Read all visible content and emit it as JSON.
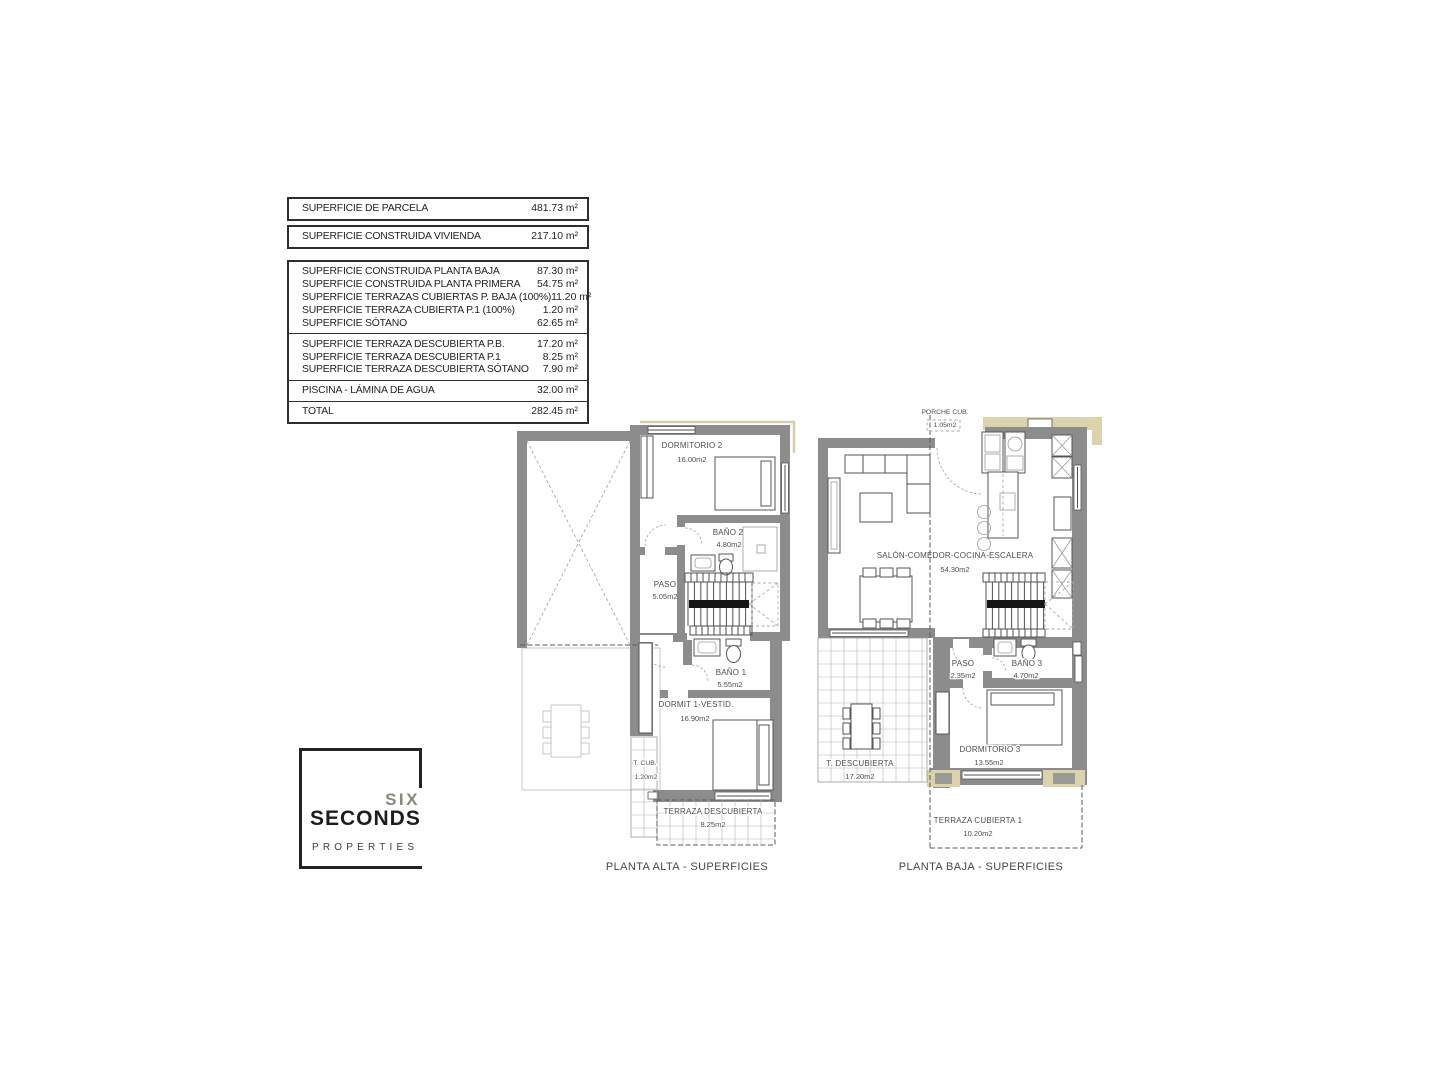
{
  "area_table": {
    "box1": {
      "rows": [
        {
          "label": "SUPERFICIE DE PARCELA",
          "value": "481.73 m²"
        }
      ]
    },
    "box2": {
      "rows": [
        {
          "label": "SUPERFICIE CONSTRUIDA VIVIENDA",
          "value": "217.10 m²"
        }
      ]
    },
    "box3": {
      "sections": [
        {
          "rows": [
            {
              "label": "SUPERFICIE CONSTRUIDA PLANTA BAJA",
              "value": "87.30 m²"
            },
            {
              "label": "SUPERFICIE CONSTRUIDA PLANTA PRIMERA",
              "value": "54.75 m²"
            },
            {
              "label": "SUPERFICIE TERRAZAS CUBIERTAS P. BAJA (100%)",
              "value": "11.20 m²"
            },
            {
              "label": "SUPERFICIE TERRAZA CUBIERTA P.1 (100%)",
              "value": "1.20 m²"
            },
            {
              "label": "SUPERFICIE SÓTANO",
              "value": "62.65 m²"
            }
          ]
        },
        {
          "rows": [
            {
              "label": "SUPERFICIE TERRAZA DESCUBIERTA P.B.",
              "value": "17.20 m²"
            },
            {
              "label": "SUPERFICIE TERRAZA DESCUBIERTA P.1",
              "value": "8.25 m²"
            },
            {
              "label": "SUPERFICIE TERRAZA DESCUBIERTA SÓTANO",
              "value": "7.90 m²"
            }
          ]
        },
        {
          "rows": [
            {
              "label": "PISCINA - LÁMINA DE AGUA",
              "value": "32.00 m²"
            }
          ]
        },
        {
          "rows": [
            {
              "label": "TOTAL",
              "value": "282.45 m²"
            }
          ]
        }
      ]
    }
  },
  "logo": {
    "six": "SIX",
    "seconds": "SECONDS",
    "properties": "PROPERTIES"
  },
  "plans": {
    "left": {
      "caption": "PLANTA ALTA - SUPERFICIES",
      "rooms": {
        "dormitorio2": {
          "name": "DORMITORIO 2",
          "area": "16.00m2"
        },
        "bano2": {
          "name": "BAÑO 2",
          "area": "4.80m2"
        },
        "paso": {
          "name": "PASO",
          "area": "5.05m2"
        },
        "bano1": {
          "name": "BAÑO 1",
          "area": "5.55m2"
        },
        "dormit1": {
          "name": "DORMIT 1-VESTID.",
          "area": "16.90m2"
        },
        "tcub": {
          "name": "T. CUB.",
          "area": "1.20m2"
        },
        "terraza_descubierta": {
          "name": "TERRAZA DESCUBIERTA",
          "area": "8.25m2"
        }
      }
    },
    "right": {
      "caption": "PLANTA BAJA - SUPERFICIES",
      "rooms": {
        "porche": {
          "name": "PORCHE CUB.",
          "area": "1.05m2"
        },
        "salon": {
          "name": "SALÓN-COMEDOR-COCINA-ESCALERA",
          "area": "54.30m2"
        },
        "paso": {
          "name": "PASO",
          "area": "2.35m2"
        },
        "bano3": {
          "name": "BAÑO 3",
          "area": "4.70m2"
        },
        "dormitorio3": {
          "name": "DORMITORIO 3",
          "area": "13.55m2"
        },
        "tdescubierta": {
          "name": "T. DESCUBIERTA",
          "area": "17.20m2"
        },
        "terraza_cubierta1": {
          "name": "TERRAZA CUBIERTA 1",
          "area": "10.20m2"
        }
      }
    }
  },
  "colors": {
    "wall": "#8c8c8c",
    "tan_accent": "#dcd2ae",
    "ink": "#1f1f1f",
    "ghost": "#c7c7c7"
  }
}
